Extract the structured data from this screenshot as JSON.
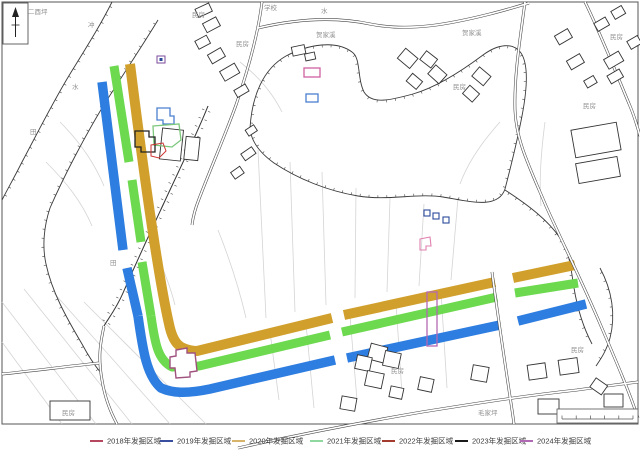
{
  "figure": {
    "type": "archaeological excavation site plan",
    "place_labels": [
      {
        "text": "二酉坪",
        "x": 28,
        "y": 14
      },
      {
        "text": "冲",
        "x": 88,
        "y": 27
      },
      {
        "text": "水",
        "x": 72,
        "y": 89
      },
      {
        "text": "田",
        "x": 30,
        "y": 134
      },
      {
        "text": "田",
        "x": 110,
        "y": 265
      },
      {
        "text": "民房",
        "x": 192,
        "y": 17
      },
      {
        "text": "学校",
        "x": 264,
        "y": 10
      },
      {
        "text": "水",
        "x": 321,
        "y": 13
      },
      {
        "text": "贺家溪",
        "x": 316,
        "y": 37
      },
      {
        "text": "民房",
        "x": 236,
        "y": 46
      },
      {
        "text": "贺家溪",
        "x": 462,
        "y": 35
      },
      {
        "text": "民房",
        "x": 453,
        "y": 89
      },
      {
        "text": "民房",
        "x": 610,
        "y": 39
      },
      {
        "text": "民房",
        "x": 583,
        "y": 108
      },
      {
        "text": "民房",
        "x": 62,
        "y": 415
      },
      {
        "text": "民房",
        "x": 391,
        "y": 373
      },
      {
        "text": "民房",
        "x": 571,
        "y": 352
      },
      {
        "text": "毛家坪",
        "x": 478,
        "y": 415
      }
    ],
    "band_colors": {
      "blue_2019": "#2e7de0",
      "yellow_2020": "#d1a02c",
      "green_2021": "#6cd94e"
    },
    "marker_colors": {
      "blue_outline": "#4a7fd0",
      "green_outline": "#7cc87c",
      "black_outline": "#222222",
      "red_outline": "#cc3333",
      "corner_purple": "#a0527f",
      "purple_rect_2024": "#b468b4",
      "pink_rect": "#d060a0",
      "pink_poly": "#e080b0",
      "tiny_purple": "#7a4a9a",
      "tiny_blue": "#2a4a9a"
    }
  },
  "legend": {
    "items": [
      {
        "label": "2018年发掘区域",
        "color": "#b5485f"
      },
      {
        "label": "2019年发掘区域",
        "color": "#3a4e9f"
      },
      {
        "label": "2020年发掘区域",
        "color": "#d8b36a"
      },
      {
        "label": "2021年发掘区域",
        "color": "#8fd9a0"
      },
      {
        "label": "2022年发掘区域",
        "color": "#a33b2e"
      },
      {
        "label": "2023年发掘区域",
        "color": "#1a1a1a"
      },
      {
        "label": "2024年发掘区域",
        "color": "#b06ab3"
      }
    ]
  }
}
